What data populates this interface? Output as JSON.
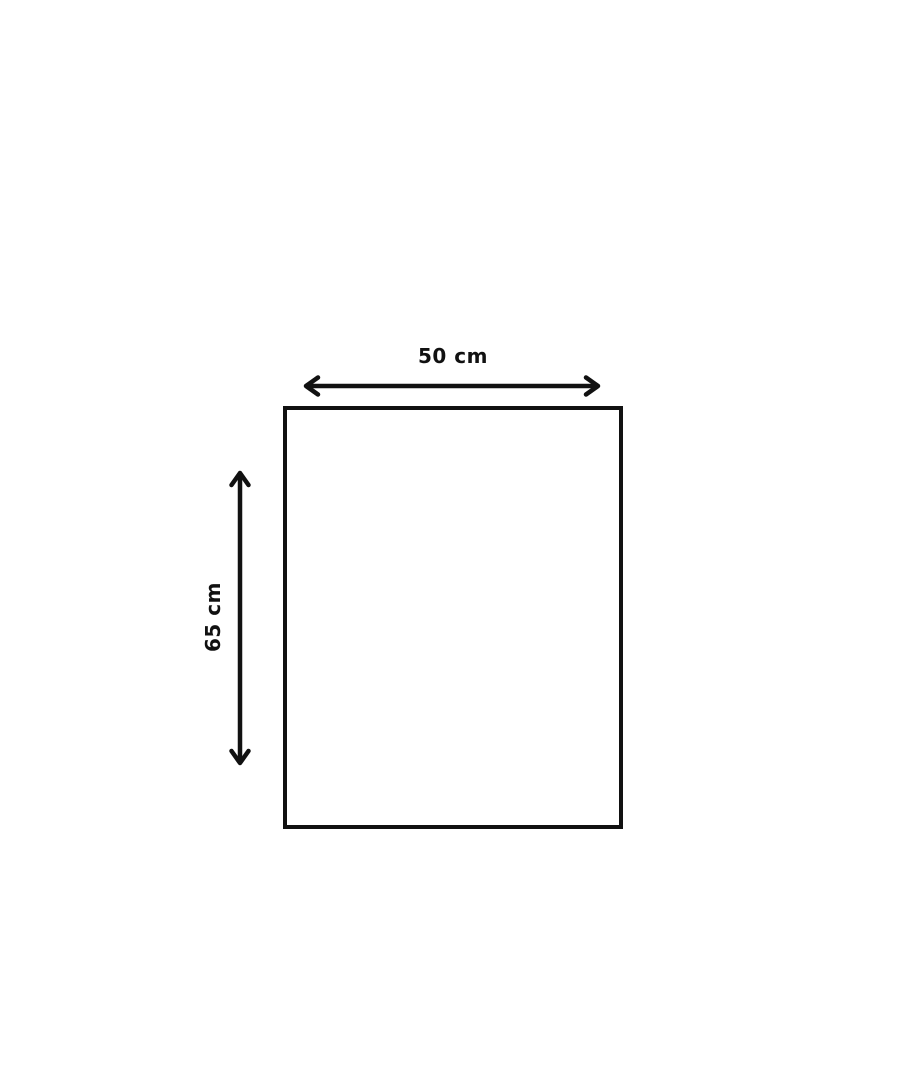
{
  "page": {
    "background": "#ffffff"
  },
  "diagram": {
    "shape": "rectangle",
    "stroke_color": "#111111",
    "width": {
      "value": 50,
      "unit": "cm",
      "label": "50 cm"
    },
    "height": {
      "value": 65,
      "unit": "cm",
      "label": "65 cm"
    }
  }
}
